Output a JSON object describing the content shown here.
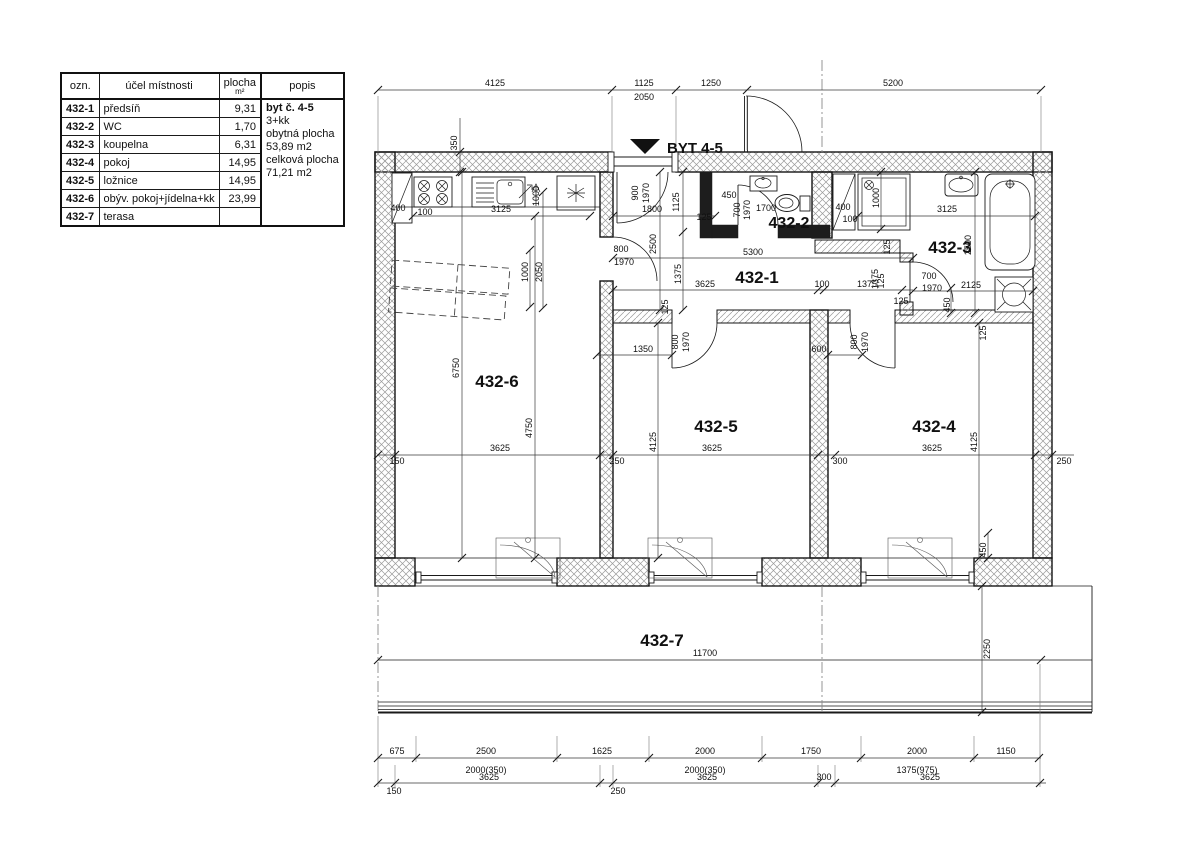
{
  "legend_table": {
    "headers": {
      "ozn": "ozn.",
      "purpose": "účel místnosti",
      "area": "plocha",
      "area_unit": "m²",
      "popis": "popis"
    },
    "rows": [
      {
        "ozn": "432-1",
        "purpose": "předsíň",
        "area": "9,31"
      },
      {
        "ozn": "432-2",
        "purpose": "WC",
        "area": "1,70"
      },
      {
        "ozn": "432-3",
        "purpose": "koupelna",
        "area": "6,31"
      },
      {
        "ozn": "432-4",
        "purpose": "pokoj",
        "area": "14,95"
      },
      {
        "ozn": "432-5",
        "purpose": "ložnice",
        "area": "14,95"
      },
      {
        "ozn": "432-6",
        "purpose": "obýv. pokoj+jídelna+kk",
        "area": "23,99"
      },
      {
        "ozn": "432-7",
        "purpose": "terasa",
        "area": ""
      }
    ],
    "popis_lines": [
      "byt č. 4-5",
      "3+kk",
      "obytná plocha",
      "53,89 m2",
      "celková plocha",
      "71,21 m2"
    ]
  },
  "plan": {
    "entrance_label": "BYT 4-5",
    "room_ids": [
      "432-1",
      "432-2",
      "432-3",
      "432-4",
      "432-5",
      "432-6",
      "432-7"
    ],
    "labels": [
      {
        "t": "4125",
        "x": 495,
        "y": 86
      },
      {
        "t": "1125",
        "x": 644,
        "y": 86
      },
      {
        "t": "2050",
        "x": 644,
        "y": 100
      },
      {
        "t": "1250",
        "x": 711,
        "y": 86
      },
      {
        "t": "5200",
        "x": 893,
        "y": 86
      },
      {
        "t": "350",
        "x": 457,
        "y": 143,
        "r": -90
      },
      {
        "t": "400",
        "x": 398,
        "y": 211
      },
      {
        "t": "100",
        "x": 425,
        "y": 215
      },
      {
        "t": "3125",
        "x": 501,
        "y": 212
      },
      {
        "t": "1000",
        "x": 539,
        "y": 196,
        "r": -90
      },
      {
        "t": "1000",
        "x": 528,
        "y": 272,
        "r": -90
      },
      {
        "t": "2050",
        "x": 542,
        "y": 272,
        "r": -90
      },
      {
        "t": "6750",
        "x": 459,
        "y": 368,
        "r": -90
      },
      {
        "t": "4750",
        "x": 532,
        "y": 428,
        "r": -90
      },
      {
        "t": "3625",
        "x": 500,
        "y": 451
      },
      {
        "t": "150",
        "x": 397,
        "y": 464
      },
      {
        "t": "250",
        "x": 617,
        "y": 464
      },
      {
        "t": "900",
        "x": 638,
        "y": 193,
        "r": -90
      },
      {
        "t": "1970",
        "x": 649,
        "y": 193,
        "r": -90
      },
      {
        "t": "1800",
        "x": 652,
        "y": 212
      },
      {
        "t": "1125",
        "x": 679,
        "y": 202,
        "r": -90
      },
      {
        "t": "2500",
        "x": 656,
        "y": 244,
        "r": -90
      },
      {
        "t": "1375",
        "x": 681,
        "y": 274,
        "r": -90
      },
      {
        "t": "125",
        "x": 668,
        "y": 307,
        "r": -90
      },
      {
        "t": "800",
        "x": 621,
        "y": 252
      },
      {
        "t": "1970",
        "x": 624,
        "y": 265
      },
      {
        "t": "5300",
        "x": 753,
        "y": 255
      },
      {
        "t": "3625",
        "x": 705,
        "y": 287
      },
      {
        "t": "100",
        "x": 822,
        "y": 287
      },
      {
        "t": "1375",
        "x": 867,
        "y": 287
      },
      {
        "t": "125",
        "x": 884,
        "y": 281,
        "r": -90
      },
      {
        "t": "1350",
        "x": 643,
        "y": 352
      },
      {
        "t": "800",
        "x": 678,
        "y": 342,
        "r": -90
      },
      {
        "t": "1970",
        "x": 689,
        "y": 342,
        "r": -90
      },
      {
        "t": "600",
        "x": 819,
        "y": 352
      },
      {
        "t": "800",
        "x": 857,
        "y": 342,
        "r": -90
      },
      {
        "t": "1970",
        "x": 868,
        "y": 342,
        "r": -90
      },
      {
        "t": "450",
        "x": 729,
        "y": 198
      },
      {
        "t": "700",
        "x": 740,
        "y": 210,
        "r": -90
      },
      {
        "t": "1970",
        "x": 750,
        "y": 210,
        "r": -90
      },
      {
        "t": "1700",
        "x": 766,
        "y": 211
      },
      {
        "t": "125",
        "x": 704,
        "y": 220
      },
      {
        "t": "400",
        "x": 843,
        "y": 210
      },
      {
        "t": "100",
        "x": 850,
        "y": 222
      },
      {
        "t": "1000",
        "x": 879,
        "y": 198,
        "r": -90
      },
      {
        "t": "3125",
        "x": 947,
        "y": 212
      },
      {
        "t": "2500",
        "x": 971,
        "y": 245,
        "r": -90
      },
      {
        "t": "125",
        "x": 890,
        "y": 247,
        "r": -90
      },
      {
        "t": "1375",
        "x": 878,
        "y": 279,
        "r": -90
      },
      {
        "t": "700",
        "x": 929,
        "y": 279
      },
      {
        "t": "1970",
        "x": 932,
        "y": 291
      },
      {
        "t": "125",
        "x": 901,
        "y": 304
      },
      {
        "t": "450",
        "x": 950,
        "y": 305,
        "r": -90
      },
      {
        "t": "2125",
        "x": 971,
        "y": 288
      },
      {
        "t": "125",
        "x": 986,
        "y": 333,
        "r": -90
      },
      {
        "t": "4125",
        "x": 656,
        "y": 442,
        "r": -90
      },
      {
        "t": "3625",
        "x": 712,
        "y": 451
      },
      {
        "t": "300",
        "x": 840,
        "y": 464
      },
      {
        "t": "3625",
        "x": 932,
        "y": 451
      },
      {
        "t": "4125",
        "x": 977,
        "y": 442,
        "r": -90
      },
      {
        "t": "250",
        "x": 1064,
        "y": 464
      },
      {
        "t": "450",
        "x": 986,
        "y": 550,
        "r": -90
      },
      {
        "t": "11700",
        "x": 705,
        "y": 656
      },
      {
        "t": "2250",
        "x": 990,
        "y": 649,
        "r": -90
      },
      {
        "t": "675",
        "x": 397,
        "y": 754
      },
      {
        "t": "2500",
        "x": 486,
        "y": 754
      },
      {
        "t": "1625",
        "x": 602,
        "y": 754
      },
      {
        "t": "2000",
        "x": 705,
        "y": 754
      },
      {
        "t": "1750",
        "x": 811,
        "y": 754
      },
      {
        "t": "2000",
        "x": 917,
        "y": 754
      },
      {
        "t": "1150",
        "x": 1006,
        "y": 754
      },
      {
        "t": "2000(350)",
        "x": 486,
        "y": 773
      },
      {
        "t": "2000(350)",
        "x": 705,
        "y": 773
      },
      {
        "t": "1375(975)",
        "x": 917,
        "y": 773
      },
      {
        "t": "150",
        "x": 394,
        "y": 794
      },
      {
        "t": "3625",
        "x": 489,
        "y": 780
      },
      {
        "t": "250",
        "x": 618,
        "y": 794
      },
      {
        "t": "3625",
        "x": 707,
        "y": 780
      },
      {
        "t": "300",
        "x": 824,
        "y": 780
      },
      {
        "t": "3625",
        "x": 930,
        "y": 780
      },
      {
        "t": "432-6",
        "x": 497,
        "y": 387,
        "s": 17,
        "b": 1,
        "n": "room-label-432-6"
      },
      {
        "t": "432-1",
        "x": 757,
        "y": 283,
        "s": 17,
        "b": 1,
        "n": "room-label-432-1"
      },
      {
        "t": "432-2",
        "x": 789,
        "y": 228,
        "s": 16,
        "b": 1,
        "n": "room-label-432-2"
      },
      {
        "t": "432-3",
        "x": 950,
        "y": 253,
        "s": 17,
        "b": 1,
        "n": "room-label-432-3"
      },
      {
        "t": "432-5",
        "x": 716,
        "y": 432,
        "s": 17,
        "b": 1,
        "n": "room-label-432-5"
      },
      {
        "t": "432-4",
        "x": 934,
        "y": 432,
        "s": 17,
        "b": 1,
        "n": "room-label-432-4"
      },
      {
        "t": "432-7",
        "x": 662,
        "y": 646,
        "s": 17,
        "b": 1,
        "n": "room-label-432-7"
      },
      {
        "t": "BYT 4-5",
        "x": 667,
        "y": 153,
        "s": 15,
        "b": 1,
        "a": "start",
        "n": "entrance-label"
      }
    ]
  },
  "colors": {
    "line": "#1a1a1a",
    "hatch": "#9a9a9a",
    "dim": "#3a3a3a",
    "background": "#ffffff"
  }
}
